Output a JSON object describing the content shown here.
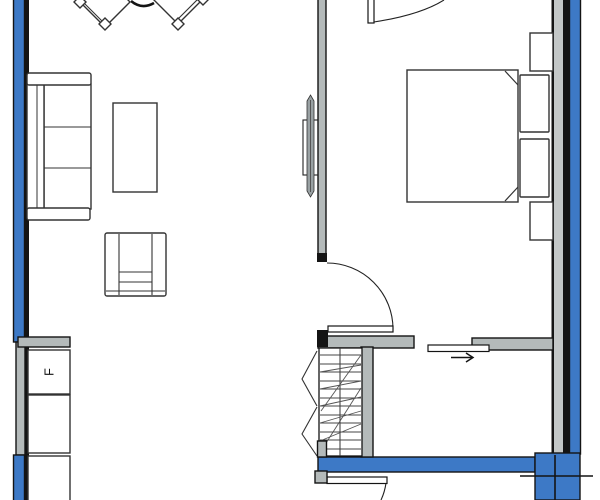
{
  "labels": {
    "fridge": "F"
  },
  "icons": {
    "slide_arrow": "right-arrow"
  },
  "colors": {
    "background": "#ffffff",
    "exterior_wall_blue": "#3d79c6",
    "interior_wall_gray": "#b4baba",
    "wall_liner_gray": "#c3c7c7",
    "outline_black": "#141414",
    "furniture_line": "#333333",
    "tv_fill": "#99a1a3"
  }
}
